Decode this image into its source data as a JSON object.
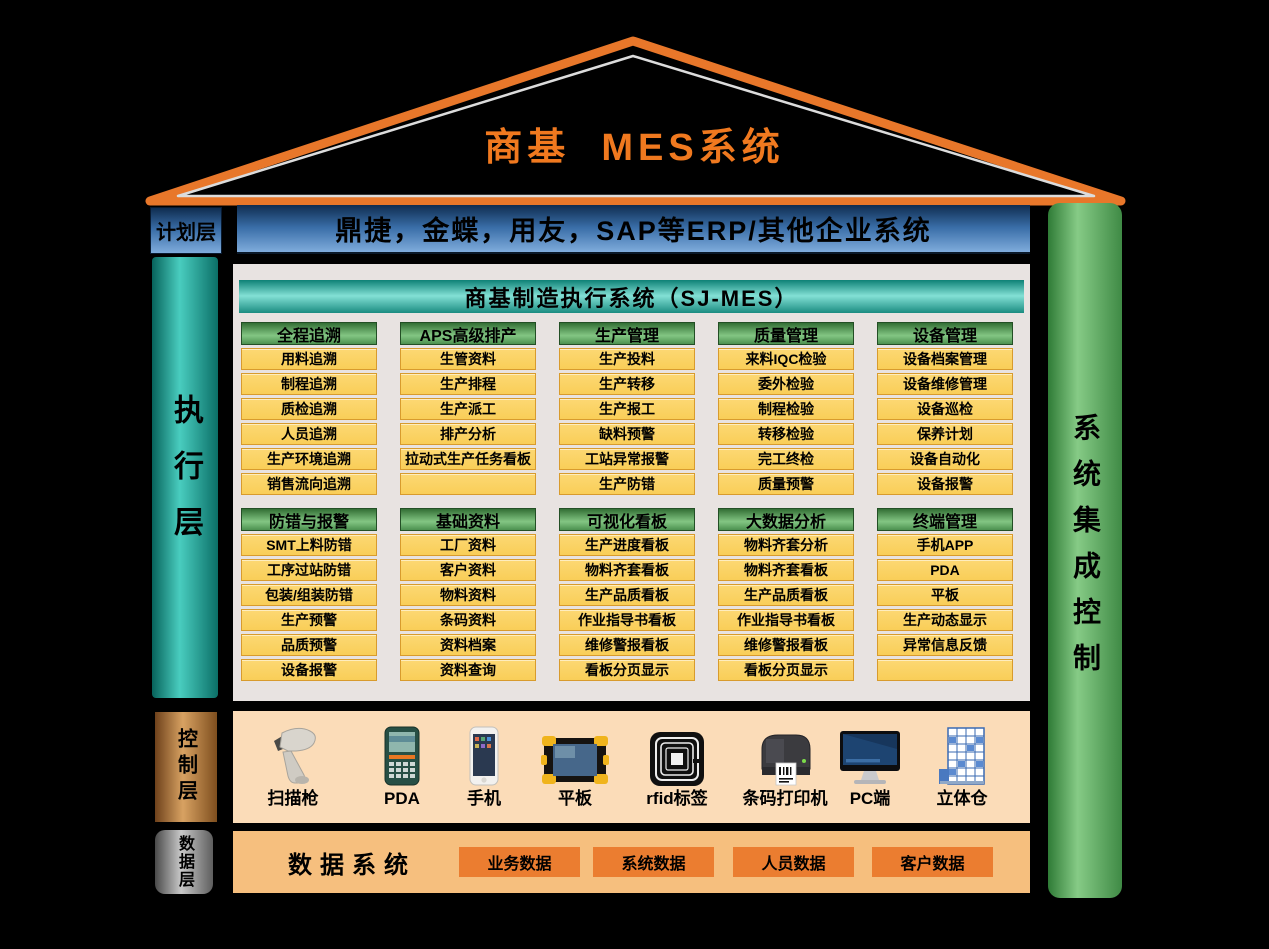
{
  "colors": {
    "background": "#000000",
    "roof_orange": "#E8772A",
    "title_orange": "#F0791F",
    "plan_blue_dark": "#0F2D50",
    "plan_blue_light": "#7FACDC",
    "exec_teal": "#49CDBF",
    "panel_gray": "#E8E3E1",
    "sjmes_teal": "#83E0D5",
    "module_green": "#83C683",
    "item_yellow": "#FBD466",
    "item_border": "#D89B2D",
    "control_copper": "#D8A262",
    "control_bg": "#FBDCB8",
    "data_bg": "#F6BF7E",
    "data_item_orange": "#EB7D30",
    "integration_green": "#86CB86"
  },
  "roof": {
    "title": "商基  MES系统"
  },
  "plan_layer": {
    "label": "计划层",
    "erp_text": "鼎捷，金蝶，用友，SAP等ERP/其他企业系统"
  },
  "execution_layer": {
    "label": "执行层",
    "panel_title": "商基制造执行系统（SJ-MES）",
    "rows": [
      {
        "columns": [
          {
            "title": "全程追溯",
            "items": [
              "用料追溯",
              "制程追溯",
              "质检追溯",
              "人员追溯",
              "生产环境追溯",
              "销售流向追溯"
            ]
          },
          {
            "title": "APS高级排产",
            "items": [
              "生管资料",
              "生产排程",
              "生产派工",
              "排产分析",
              "拉动式生产任务看板",
              ""
            ]
          },
          {
            "title": "生产管理",
            "items": [
              "生产投料",
              "生产转移",
              "生产报工",
              "缺料预警",
              "工站异常报警",
              "生产防错"
            ]
          },
          {
            "title": "质量管理",
            "items": [
              "来料IQC检验",
              "委外检验",
              "制程检验",
              "转移检验",
              "完工终检",
              "质量预警"
            ]
          },
          {
            "title": "设备管理",
            "items": [
              "设备档案管理",
              "设备维修管理",
              "设备巡检",
              "保养计划",
              "设备自动化",
              "设备报警"
            ]
          }
        ]
      },
      {
        "columns": [
          {
            "title": "防错与报警",
            "items": [
              "SMT上料防错",
              "工序过站防错",
              "包装/组装防错",
              "生产预警",
              "品质预警",
              "设备报警"
            ]
          },
          {
            "title": "基础资料",
            "items": [
              "工厂资料",
              "客户资料",
              "物料资料",
              "条码资料",
              "资料档案",
              "资料查询"
            ]
          },
          {
            "title": "可视化看板",
            "items": [
              "生产进度看板",
              "物料齐套看板",
              "生产品质看板",
              "作业指导书看板",
              "维修警报看板",
              "看板分页显示"
            ]
          },
          {
            "title": "大数据分析",
            "items": [
              "物料齐套分析",
              "物料齐套看板",
              "生产品质看板",
              "作业指导书看板",
              "维修警报看板",
              "看板分页显示"
            ]
          },
          {
            "title": "终端管理",
            "items": [
              "手机APP",
              "PDA",
              "平板",
              "生产动态显示",
              "异常信息反馈",
              ""
            ]
          }
        ]
      }
    ]
  },
  "control_layer": {
    "label": "控制层",
    "devices": [
      {
        "name": "扫描枪",
        "icon": "scanner-icon"
      },
      {
        "name": "PDA",
        "icon": "pda-icon"
      },
      {
        "name": "手机",
        "icon": "phone-icon"
      },
      {
        "name": "平板",
        "icon": "tablet-icon"
      },
      {
        "name": "rfid标签",
        "icon": "rfid-icon"
      },
      {
        "name": "条码打印机",
        "icon": "barcode-printer-icon"
      },
      {
        "name": "PC端",
        "icon": "pc-monitor-icon"
      },
      {
        "name": "立体仓",
        "icon": "warehouse-icon"
      }
    ]
  },
  "data_layer": {
    "label": "数据层",
    "title": "数据系统",
    "items": [
      "业务数据",
      "系统数据",
      "人员数据",
      "客户数据"
    ]
  },
  "integration_bar": {
    "label": "系统集成控制"
  }
}
